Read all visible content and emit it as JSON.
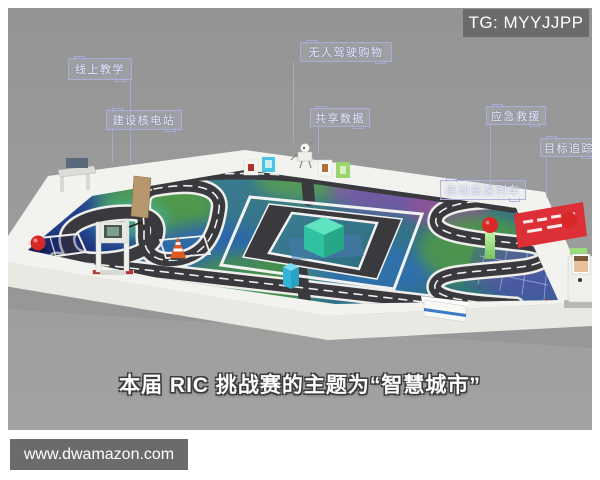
{
  "watermarks": {
    "telegram": "TG: MYYJJPP",
    "website": "www.dwamazon.com"
  },
  "subtitle": {
    "text": "本届 RIC 挑战赛的主题为“智慧城市”"
  },
  "field_labels": [
    {
      "id": "online-teaching",
      "text": "线上教学"
    },
    {
      "id": "build-nuclear-plant",
      "text": "建设核电站"
    },
    {
      "id": "driverless-shopping",
      "text": "无人驾驶购物"
    },
    {
      "id": "share-data",
      "text": "共享数据"
    },
    {
      "id": "emergency-rescue",
      "text": "应急救援"
    },
    {
      "id": "target-tracking",
      "text": "目标追踪"
    },
    {
      "id": "start-high-speed-train",
      "text": "启动高速列车"
    }
  ],
  "mat": {
    "marking": "00"
  },
  "colors": {
    "backdrop": "#9a9a9a",
    "table_white": "#f2f2ee",
    "mat_teal": "#35788c",
    "road": "#3a3a3e",
    "label_border": "#a8aedd",
    "sign_red": "#dd2f36",
    "cube_teal": "#3fd0ac",
    "cube_cyan": "#30b4d8",
    "cone_orange": "#e05a20",
    "ball_red": "#d82828",
    "watermark_bg": "#6b6b6b"
  }
}
